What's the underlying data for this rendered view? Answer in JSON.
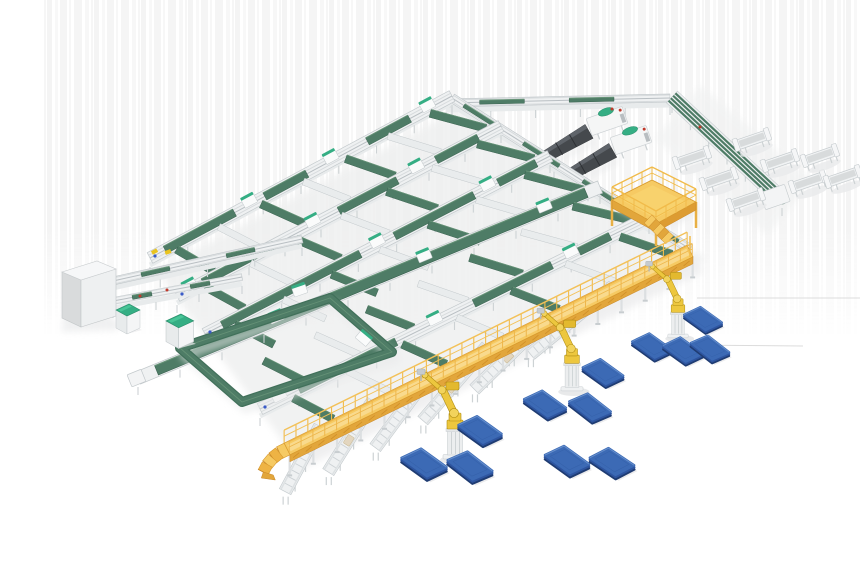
{
  "meta": {
    "title": "3D render of an automated parcel sorting and robotic palletizing facility",
    "background": "#ffffff"
  },
  "palette": {
    "green_belt": "#4e7c66",
    "green_dark": "#3a6250",
    "green_light": "#679478",
    "teal_accent": "#35ae84",
    "teal_light": "#49c597",
    "structure_yellow": "#f6ca63",
    "yellow_edge": "#d89a2e",
    "yellow_deep": "#e2a63b",
    "ramp_dark": "#c9882a",
    "rail_yellow": "#f1bb4a",
    "deck_highlight": "#fadf9b",
    "robot_yellow": "#edc73e",
    "robot_joint": "#f2d35c",
    "robot_outline": "#b08d12",
    "pallet_top": "#3c6ab5",
    "pallet_mid": "#2e55a0",
    "pallet_dark": "#1f3c72",
    "pallet_hi": "#7198d2",
    "frame_white": "#eff1f2",
    "frame_line": "#c3c9cc",
    "frame_inner": "#d7dbdd",
    "slot_gray": "#d8dbdc",
    "leg_gray": "#cdd2d4",
    "machine_dark": "#45494d",
    "machine_dark_top": "#5f646a",
    "dot_red": "#c0392b",
    "dot_blue": "#3a5bc7",
    "dot_yellow": "#e9c31f",
    "shadow": "#e9eaeb",
    "stripe": "#ededed",
    "crate_tan": "#e3d6bf"
  },
  "components": {
    "sorter_lines": {
      "label": "green belt sorter lines",
      "count": 5
    },
    "cross_belts": {
      "label": "inclined transfer belts",
      "count": 35
    },
    "telescopic_loaders": {
      "label": "dark telescopic loading machines",
      "count": 2
    },
    "operator_platform": {
      "label": "yellow mezzanine platform with stairs",
      "count": 1
    },
    "elevated_walkway": {
      "label": "yellow elevated walkway with railing and ramp",
      "count": 1
    },
    "palletizing_robots": {
      "label": "yellow robotic arms on pedestals",
      "count": 3
    },
    "pallets": {
      "label": "blue floor pallets",
      "count": 12
    },
    "discharge_bins": {
      "label": "white discharge trough bins",
      "count": 8
    },
    "outfeed_conveyors": {
      "label": "roller outfeed lanes under walkway",
      "count": 6
    },
    "control_cabinet": {
      "label": "gray control cabinet",
      "count": 1
    },
    "infeed_machines": {
      "label": "teal-top infeed machines",
      "count": 2
    },
    "conveyor_loop": {
      "label": "green recirculation loop",
      "count": 1
    }
  },
  "scene": {
    "canvas": {
      "w": 860,
      "h": 580
    },
    "stripes": {
      "x": 42,
      "y": 0,
      "w": 816,
      "h": 334
    },
    "artifact_lines": [
      {
        "x1": 697,
        "y1": 298,
        "x2": 860,
        "y2": 298
      },
      {
        "x1": 677,
        "y1": 345,
        "x2": 803,
        "y2": 346
      }
    ],
    "grid_shadow": [
      [
        150,
        262
      ],
      [
        452,
        100
      ],
      [
        700,
        250
      ],
      [
        290,
        452
      ]
    ],
    "sorter_lines": [
      {
        "from": [
          150,
          258
        ],
        "to": [
          452,
          96
        ],
        "style": "standard",
        "greens": [
          [
            0.05,
            0.28
          ],
          [
            0.38,
            0.52
          ],
          [
            0.72,
            0.86
          ]
        ],
        "modules": [
          0.33,
          0.6,
          0.92
        ],
        "cap": "yellow"
      },
      {
        "from": [
          177,
          296
        ],
        "to": [
          501,
          126
        ],
        "style": "standard",
        "greens": [
          [
            0.08,
            0.3
          ],
          [
            0.5,
            0.68
          ],
          [
            0.8,
            0.93
          ]
        ],
        "modules": [
          0.04,
          0.42,
          0.74
        ]
      },
      {
        "from": [
          205,
          334
        ],
        "to": [
          550,
          156
        ],
        "style": "standard",
        "greens": [
          [
            0.05,
            0.45
          ],
          [
            0.55,
            0.78
          ],
          [
            0.85,
            0.96
          ]
        ],
        "modules": [
          0.5,
          0.82
        ]
      },
      {
        "from": [
          138,
          378
        ],
        "to": [
          600,
          187
        ],
        "style": "wide_green",
        "greens": [
          [
            0.04,
            0.97
          ]
        ],
        "modules": [
          0.3,
          0.62,
          0.88
        ]
      },
      {
        "from": [
          260,
          409
        ],
        "to": [
          649,
          217
        ],
        "style": "standard",
        "greens": [
          [
            0.1,
            0.35
          ],
          [
            0.55,
            0.75
          ],
          [
            0.82,
            0.9
          ]
        ],
        "modules": [
          0.05,
          0.45,
          0.8
        ]
      }
    ],
    "gap_lines": [
      [
        [
          150,
          258
        ],
        [
          452,
          96
        ]
      ],
      [
        [
          177,
          296
        ],
        [
          501,
          126
        ]
      ],
      [
        [
          205,
          334
        ],
        [
          550,
          156
        ]
      ],
      [
        [
          232,
          371
        ],
        [
          600,
          187
        ]
      ],
      [
        [
          260,
          409
        ],
        [
          649,
          217
        ]
      ],
      [
        [
          287,
          447
        ],
        [
          690,
          251
        ]
      ]
    ],
    "belt_ts": [
      0.08,
      0.22,
      0.36,
      0.5,
      0.64,
      0.78,
      0.92
    ],
    "top_line": {
      "from": [
        446,
        103
      ],
      "to": [
        670,
        98
      ],
      "greens": [
        [
          0.15,
          0.35
        ],
        [
          0.55,
          0.75
        ]
      ]
    },
    "edge_spine": {
      "from": [
        452,
        98
      ],
      "to": [
        690,
        249
      ],
      "greens": [
        [
          0.05,
          0.2
        ],
        [
          0.3,
          0.45
        ],
        [
          0.55,
          0.7
        ],
        [
          0.8,
          0.95
        ]
      ]
    },
    "corner_spine": {
      "from": [
        672,
        97
      ],
      "to": [
        782,
        200
      ]
    },
    "spine_end_unit": {
      "x": 762,
      "y": 188,
      "w": 26,
      "h": 18
    },
    "loaders": [
      {
        "tail": [
          543,
          158
        ],
        "head": [
          607,
          121
        ]
      },
      {
        "tail": [
          566,
          177
        ],
        "head": [
          631,
          140
        ]
      }
    ],
    "mezzanine": {
      "deck": [
        [
          612,
          200
        ],
        [
          652,
          180
        ],
        [
          696,
          202
        ],
        [
          656,
          224
        ]
      ],
      "stair_from": [
        648,
        219
      ],
      "stair_dir": 44,
      "stair_steps": 5
    },
    "tray_angle": -19,
    "trays": [
      {
        "x": 692,
        "y": 158
      },
      {
        "x": 719,
        "y": 179
      },
      {
        "x": 746,
        "y": 200
      },
      {
        "x": 752,
        "y": 140
      },
      {
        "x": 780,
        "y": 161
      },
      {
        "x": 808,
        "y": 182
      },
      {
        "x": 820,
        "y": 156
      },
      {
        "x": 843,
        "y": 177
      }
    ],
    "loop": {
      "path": [
        [
          180,
          348
        ],
        [
          330,
          298
        ],
        [
          392,
          352
        ],
        [
          242,
          402
        ]
      ]
    },
    "cabinet": {
      "top": [
        [
          62,
          272
        ],
        [
          97,
          261
        ],
        [
          116,
          269
        ],
        [
          81,
          280
        ]
      ],
      "left": [
        [
          62,
          272
        ],
        [
          81,
          280
        ],
        [
          81,
          327
        ],
        [
          62,
          318
        ]
      ],
      "front": [
        [
          81,
          280
        ],
        [
          116,
          269
        ],
        [
          116,
          316
        ],
        [
          81,
          327
        ]
      ]
    },
    "machines": [
      {
        "x": 116,
        "y": 304,
        "s": 1.0
      },
      {
        "x": 166,
        "y": 314,
        "s": 1.15
      }
    ],
    "connectors": [
      {
        "from": [
          113,
          281
        ],
        "to": [
          302,
          239
        ],
        "w": 8
      },
      {
        "from": [
          113,
          301
        ],
        "to": [
          242,
          277
        ],
        "w": 7
      }
    ],
    "walkway": {
      "from": [
        287,
        449
      ],
      "to": [
        690,
        251
      ],
      "w": 13,
      "ramp_steps": 4
    },
    "lanes": {
      "ts": [
        0.07,
        0.2,
        0.34,
        0.48,
        0.63,
        0.79
      ],
      "lens": [
        64,
        74,
        82,
        88,
        93,
        97
      ],
      "crate_on": [
        1,
        3,
        4
      ]
    },
    "robots": [
      {
        "x": 455,
        "y": 458,
        "s": 1.0
      },
      {
        "x": 572,
        "y": 390,
        "s": 0.92
      },
      {
        "x": 678,
        "y": 337,
        "s": 0.85
      }
    ],
    "pallets": [
      {
        "x": 424,
        "y": 463,
        "s": 1.02,
        "r": 0
      },
      {
        "x": 470,
        "y": 466,
        "s": 1.02,
        "r": 2
      },
      {
        "x": 567,
        "y": 460,
        "s": 1.0,
        "r": 0
      },
      {
        "x": 612,
        "y": 462,
        "s": 1.0,
        "r": -2
      },
      {
        "x": 480,
        "y": 430,
        "s": 0.98,
        "r": 0
      },
      {
        "x": 545,
        "y": 404,
        "s": 0.95,
        "r": 0
      },
      {
        "x": 590,
        "y": 407,
        "s": 0.95,
        "r": 2
      },
      {
        "x": 603,
        "y": 372,
        "s": 0.92,
        "r": 0
      },
      {
        "x": 652,
        "y": 346,
        "s": 0.9,
        "r": 0
      },
      {
        "x": 683,
        "y": 350,
        "s": 0.9,
        "r": 0
      },
      {
        "x": 710,
        "y": 348,
        "s": 0.88,
        "r": 2
      },
      {
        "x": 703,
        "y": 319,
        "s": 0.86,
        "r": 0
      }
    ],
    "dots": {
      "blue": [
        [
          155,
          256
        ],
        [
          182,
          294
        ],
        [
          210,
          332
        ],
        [
          265,
          407
        ]
      ],
      "red": [
        [
          140,
          296
        ],
        [
          167,
          290
        ],
        [
          612,
          109
        ],
        [
          700,
          127
        ]
      ],
      "yellow": [
        [
          168,
          252
        ]
      ]
    }
  }
}
